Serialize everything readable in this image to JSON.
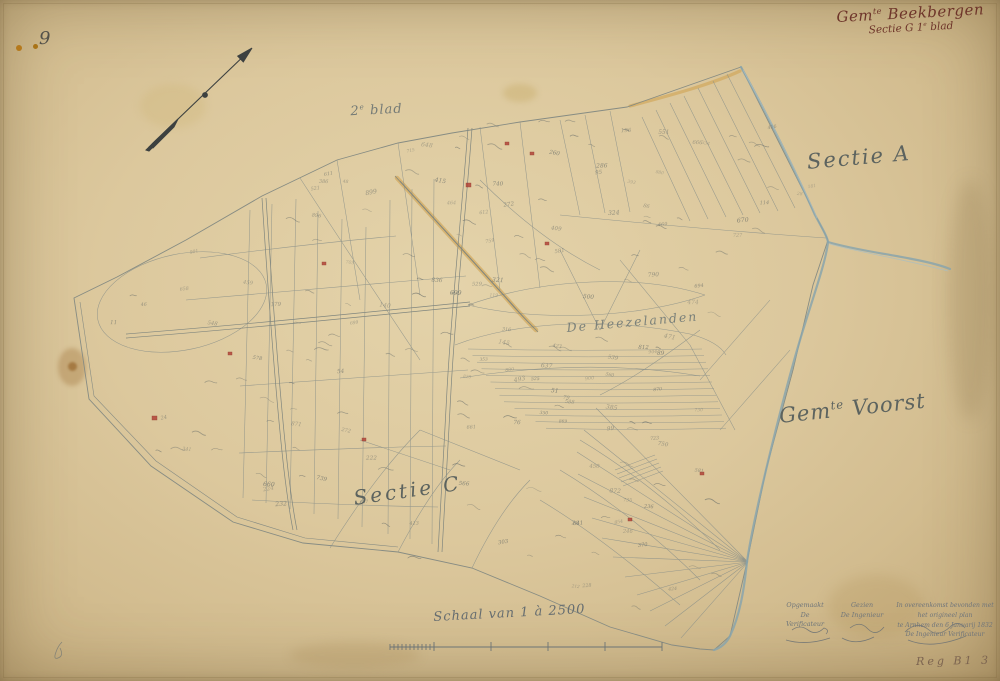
{
  "page": {
    "corner_number": "9",
    "registry_code": "Reg B1 3"
  },
  "header": {
    "gem_abbr": "Gem",
    "gem_sup": "te",
    "gem_name": " Beekbergen",
    "sectie_pre": "Sectie G 1",
    "sectie_sup": "e",
    "sectie_post": " blad"
  },
  "labels": {
    "sheet_num": "2",
    "sheet_sup": "e",
    "sheet_word": " blad",
    "sectie_a": "Sectie A",
    "area_name": "De Heezelanden",
    "voorst_abbr": "Gem",
    "voorst_sup": "te",
    "voorst_name": " Voorst",
    "sectie_c": "Sectie C"
  },
  "scale": {
    "label": "Schaal van 1 à 2500"
  },
  "signatures": {
    "approved_label": "Opgemaakt",
    "approved_role": "De Verificateur",
    "seen_label": "Gezien",
    "seen_role": "De Ingenieur",
    "note_line1": "In overeenkomst bevonden met het origineel plan",
    "note_line2": "te Arnhem den 6 Januarij 1832",
    "note_line3": "De Ingenieur Verificateur"
  },
  "icons": {
    "north_arrow": "north-arrow",
    "scale_bar": "map-scale-bar"
  },
  "colors": {
    "paper": "#dcc89d",
    "line_ink": "#8a9089",
    "water": "#8aa4ac",
    "road": "#d2a85c",
    "title_ink": "#6e352a",
    "pencil": "#6f757a",
    "registry_dot": "#b5791c",
    "building": "#b24438"
  }
}
